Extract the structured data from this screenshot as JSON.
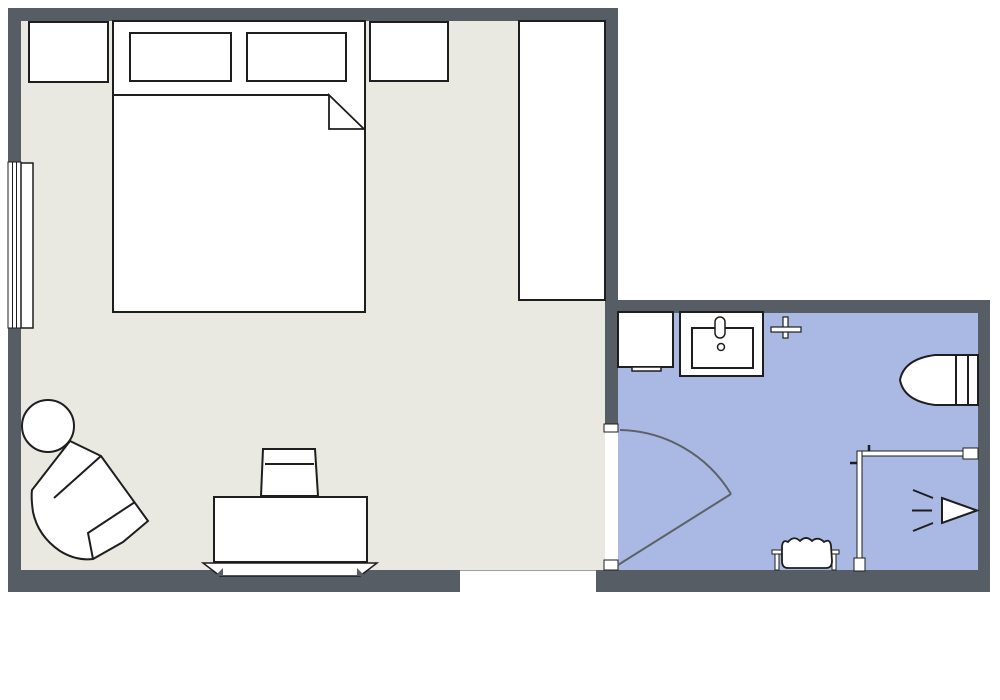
{
  "canvas": {
    "width": 1000,
    "height": 700,
    "background": "#ffffff"
  },
  "palette": {
    "wall": "#575d64",
    "bedroom_floor": "#e9e9e1",
    "bathroom_floor": "#aab9e3",
    "outline": "#1e1e1e",
    "door": "#5c6268",
    "white": "#ffffff",
    "opening_edge": "#9aa0a6"
  },
  "shapes": [
    {
      "name": "bedroom-floor",
      "kind": "rect",
      "x": 21,
      "y": 21,
      "w": 584,
      "h": 549,
      "fill": "bedroom_floor"
    },
    {
      "name": "bathroom-floor",
      "kind": "rect",
      "x": 618,
      "y": 313,
      "w": 360,
      "h": 257,
      "fill": "bathroom_floor"
    },
    {
      "name": "wall-top",
      "kind": "rect",
      "x": 8,
      "y": 8,
      "w": 610,
      "h": 13,
      "fill": "wall"
    },
    {
      "name": "wall-left",
      "kind": "rect",
      "x": 8,
      "y": 8,
      "w": 13,
      "h": 584,
      "fill": "wall"
    },
    {
      "name": "wall-bottom",
      "kind": "rect",
      "x": 8,
      "y": 570,
      "w": 982,
      "h": 22,
      "fill": "wall"
    },
    {
      "name": "wall-partition",
      "kind": "rect",
      "x": 605,
      "y": 8,
      "w": 13,
      "h": 562,
      "fill": "wall"
    },
    {
      "name": "wall-bathroom-top",
      "kind": "rect",
      "x": 605,
      "y": 300,
      "w": 385,
      "h": 13,
      "fill": "wall"
    },
    {
      "name": "wall-bathroom-right",
      "kind": "rect",
      "x": 978,
      "y": 300,
      "w": 12,
      "h": 292,
      "fill": "wall"
    },
    {
      "name": "window",
      "kind": "rect",
      "x": 8,
      "y": 162,
      "w": 13,
      "h": 166,
      "fill": "white",
      "stroke": "outline",
      "sw": 1
    },
    {
      "name": "window-pane-line-1",
      "kind": "line",
      "x1": 12.5,
      "y1": 162,
      "x2": 12.5,
      "y2": 328,
      "stroke": "outline",
      "sw": 1
    },
    {
      "name": "window-pane-line-2",
      "kind": "line",
      "x1": 16.5,
      "y1": 162,
      "x2": 16.5,
      "y2": 328,
      "stroke": "outline",
      "sw": 1
    },
    {
      "name": "window-leaf",
      "kind": "rect",
      "x": 21,
      "y": 163,
      "w": 12,
      "h": 165,
      "fill": "white",
      "stroke": "outline",
      "sw": 1.5
    },
    {
      "name": "entry-opening",
      "kind": "rect",
      "x": 460,
      "y": 570,
      "w": 136,
      "h": 22,
      "fill": "white"
    },
    {
      "name": "entry-opening-edge",
      "kind": "line",
      "x1": 460,
      "y1": 570.5,
      "x2": 596,
      "y2": 570.5,
      "stroke": "opening_edge",
      "sw": 1
    },
    {
      "name": "bathroom-door-opening",
      "kind": "rect",
      "x": 605,
      "y": 424,
      "w": 13,
      "h": 146,
      "fill": "white"
    },
    {
      "name": "bathroom-door-jamb-top",
      "kind": "rect",
      "x": 604,
      "y": 424,
      "w": 14,
      "h": 8,
      "fill": "white",
      "stroke": "outline",
      "sw": 1
    },
    {
      "name": "bathroom-door-jamb-bottom",
      "kind": "rect",
      "x": 604,
      "y": 560,
      "w": 14,
      "h": 10,
      "fill": "white",
      "stroke": "outline",
      "sw": 1
    },
    {
      "name": "bathroom-door-swing-arc",
      "kind": "path",
      "d": "M 620 430 A 133 133 0 0 1 731 494",
      "fill": "none",
      "stroke": "door",
      "sw": 2
    },
    {
      "name": "bathroom-door-leaf",
      "kind": "line",
      "x1": 731,
      "y1": 494,
      "x2": 618,
      "y2": 565,
      "stroke": "door",
      "sw": 2
    },
    {
      "name": "nightstand-left",
      "kind": "rect",
      "x": 29,
      "y": 22,
      "w": 79,
      "h": 60,
      "fill": "white",
      "stroke": "outline",
      "sw": 2
    },
    {
      "name": "bed",
      "kind": "rect",
      "x": 113,
      "y": 21,
      "w": 252,
      "h": 291,
      "fill": "white",
      "stroke": "outline",
      "sw": 2
    },
    {
      "name": "pillow-left",
      "kind": "rect",
      "x": 130,
      "y": 33,
      "w": 101,
      "h": 48,
      "fill": "white",
      "stroke": "outline",
      "sw": 2
    },
    {
      "name": "pillow-right",
      "kind": "rect",
      "x": 247,
      "y": 33,
      "w": 99,
      "h": 48,
      "fill": "white",
      "stroke": "outline",
      "sw": 2
    },
    {
      "name": "blanket-edge",
      "kind": "line",
      "x1": 113,
      "y1": 95,
      "x2": 329,
      "y2": 95,
      "stroke": "outline",
      "sw": 2
    },
    {
      "name": "blanket-fold",
      "kind": "polygon",
      "points": "329,95 364,129 329,129",
      "fill": "white",
      "stroke": "outline",
      "sw": 1.8
    },
    {
      "name": "nightstand-right",
      "kind": "rect",
      "x": 370,
      "y": 22,
      "w": 78,
      "h": 59,
      "fill": "white",
      "stroke": "outline",
      "sw": 2
    },
    {
      "name": "wardrobe",
      "kind": "rect",
      "x": 519,
      "y": 21,
      "w": 86,
      "h": 279,
      "fill": "white",
      "stroke": "outline",
      "sw": 2
    },
    {
      "name": "side-table",
      "kind": "circle",
      "cx": 48,
      "cy": 426,
      "r": 26,
      "fill": "white",
      "stroke": "outline",
      "sw": 2
    },
    {
      "name": "armchair",
      "kind": "path",
      "d": "M 70 441 L 101 456 L 148 521 L 123 542 L 93 559 Q 76 561 60 551 Q 38 536 33 512 Q 31 498 32 490 Z",
      "fill": "white",
      "stroke": "outline",
      "sw": 2
    },
    {
      "name": "armchair-backrest-line",
      "kind": "line",
      "x1": 101,
      "y1": 456,
      "x2": 54,
      "y2": 498,
      "stroke": "outline",
      "sw": 2
    },
    {
      "name": "armchair-seat-line",
      "kind": "polyline",
      "points": "135,502 88,533 93,559",
      "fill": "none",
      "stroke": "outline",
      "sw": 2
    },
    {
      "name": "desk-chair",
      "kind": "polygon",
      "points": "263,449 315,449 318,496 261,496",
      "fill": "white",
      "stroke": "outline",
      "sw": 2
    },
    {
      "name": "desk-chair-backrest-line",
      "kind": "line",
      "x1": 265,
      "y1": 464,
      "x2": 314,
      "y2": 464,
      "stroke": "outline",
      "sw": 2
    },
    {
      "name": "desk",
      "kind": "rect",
      "x": 214,
      "y": 497,
      "w": 153,
      "h": 65,
      "fill": "white",
      "stroke": "outline",
      "sw": 2
    },
    {
      "name": "desk-plinth",
      "kind": "polygon",
      "points": "203,563 377,563 360,576 220,576",
      "fill": "white",
      "stroke": "outline",
      "sw": 1.5
    },
    {
      "name": "desk-plinth-notch-left",
      "kind": "polygon",
      "points": "215,576 223,568 223,576",
      "fill": "wall"
    },
    {
      "name": "desk-plinth-notch-right",
      "kind": "polygon",
      "points": "357,568 365,576 357,576",
      "fill": "wall"
    },
    {
      "name": "bathroom-cabinet",
      "kind": "rect",
      "x": 618,
      "y": 312,
      "w": 55,
      "h": 55,
      "fill": "white",
      "stroke": "outline",
      "sw": 2
    },
    {
      "name": "bathroom-cabinet-ledge",
      "kind": "rect",
      "x": 632,
      "y": 367,
      "w": 29,
      "h": 4,
      "fill": "white",
      "stroke": "outline",
      "sw": 1.5
    },
    {
      "name": "sink-vanity",
      "kind": "rect",
      "x": 680,
      "y": 312,
      "w": 83,
      "h": 64,
      "fill": "white",
      "stroke": "outline",
      "sw": 2
    },
    {
      "name": "sink-basin",
      "kind": "rect",
      "x": 692,
      "y": 328,
      "w": 61,
      "h": 40,
      "fill": "white",
      "stroke": "outline",
      "sw": 2
    },
    {
      "name": "sink-faucet",
      "kind": "rect",
      "x": 715,
      "y": 317,
      "w": 10,
      "h": 21,
      "rx": 5,
      "fill": "white",
      "stroke": "outline",
      "sw": 1.5
    },
    {
      "name": "sink-drain",
      "kind": "circle",
      "cx": 721,
      "cy": 347,
      "r": 3.5,
      "fill": "white",
      "stroke": "outline",
      "sw": 1.5
    },
    {
      "name": "towel-hook-vertical",
      "kind": "rect",
      "x": 783,
      "y": 317,
      "w": 5,
      "h": 21,
      "fill": "white",
      "stroke": "outline",
      "sw": 1.2
    },
    {
      "name": "towel-hook-horizontal",
      "kind": "rect",
      "x": 771,
      "y": 327,
      "w": 30,
      "h": 5,
      "fill": "white",
      "stroke": "outline",
      "sw": 1.2
    },
    {
      "name": "toilet",
      "kind": "path",
      "d": "M 935 355 L 978 355 L 978 405 L 935 405 Q 904 401 900 380 Q 904 359 935 355 Z",
      "fill": "white",
      "stroke": "outline",
      "sw": 2
    },
    {
      "name": "toilet-tank-line-1",
      "kind": "line",
      "x1": 956,
      "y1": 355,
      "x2": 956,
      "y2": 405,
      "stroke": "outline",
      "sw": 2
    },
    {
      "name": "toilet-tank-line-2",
      "kind": "line",
      "x1": 968,
      "y1": 355,
      "x2": 968,
      "y2": 405,
      "stroke": "outline",
      "sw": 2
    },
    {
      "name": "shower-glass-horizontal",
      "kind": "rect",
      "x": 857,
      "y": 451,
      "w": 106,
      "h": 5,
      "fill": "white",
      "stroke": "outline",
      "sw": 1
    },
    {
      "name": "shower-glass-vertical",
      "kind": "rect",
      "x": 857,
      "y": 451,
      "w": 5,
      "h": 109,
      "fill": "white",
      "stroke": "outline",
      "sw": 1
    },
    {
      "name": "shower-glass-cap-bottom",
      "kind": "rect",
      "x": 854,
      "y": 558,
      "w": 11,
      "h": 13,
      "fill": "white",
      "stroke": "outline",
      "sw": 1
    },
    {
      "name": "shower-glass-cap-right",
      "kind": "rect",
      "x": 963,
      "y": 448,
      "w": 15,
      "h": 11,
      "fill": "white",
      "stroke": "outline",
      "sw": 1
    },
    {
      "name": "shower-handle-top",
      "kind": "line",
      "x1": 869,
      "y1": 445,
      "x2": 869,
      "y2": 451,
      "stroke": "outline",
      "sw": 2.5
    },
    {
      "name": "shower-handle-left",
      "kind": "line",
      "x1": 850,
      "y1": 463,
      "x2": 857,
      "y2": 463,
      "stroke": "outline",
      "sw": 2.5
    },
    {
      "name": "shower-head",
      "kind": "polygon",
      "points": "942,498 977,510.5 942,523",
      "fill": "white",
      "stroke": "outline",
      "sw": 2
    },
    {
      "name": "shower-spray-top",
      "kind": "line",
      "x1": 913,
      "y1": 490,
      "x2": 933,
      "y2": 498,
      "stroke": "outline",
      "sw": 2
    },
    {
      "name": "shower-spray-middle",
      "kind": "line",
      "x1": 912,
      "y1": 510.5,
      "x2": 932,
      "y2": 510.5,
      "stroke": "outline",
      "sw": 2
    },
    {
      "name": "shower-spray-bottom",
      "kind": "line",
      "x1": 913,
      "y1": 531,
      "x2": 933,
      "y2": 523,
      "stroke": "outline",
      "sw": 2
    },
    {
      "name": "towel-rail-cap-left",
      "kind": "rect",
      "x": 772,
      "y": 550,
      "w": 12,
      "h": 4,
      "fill": "white",
      "stroke": "outline",
      "sw": 1
    },
    {
      "name": "towel-rail-post-left",
      "kind": "rect",
      "x": 775,
      "y": 554,
      "w": 4,
      "h": 16,
      "fill": "white",
      "stroke": "outline",
      "sw": 1
    },
    {
      "name": "towel-rail-cap-right",
      "kind": "rect",
      "x": 827,
      "y": 550,
      "w": 12,
      "h": 4,
      "fill": "white",
      "stroke": "outline",
      "sw": 1
    },
    {
      "name": "towel-rail-post-right",
      "kind": "rect",
      "x": 832,
      "y": 554,
      "w": 4,
      "h": 16,
      "fill": "white",
      "stroke": "outline",
      "sw": 1
    },
    {
      "name": "towel",
      "kind": "path",
      "d": "M 782 546 Q 783 539 788 542 Q 794 535 800 541 Q 806 535 812 541 Q 818 536 824 542 Q 830 538 831 546 L 832 561 Q 832 568 826 568 L 788 568 Q 782 568 782 561 Z",
      "fill": "white",
      "stroke": "outline",
      "sw": 1.8
    }
  ]
}
